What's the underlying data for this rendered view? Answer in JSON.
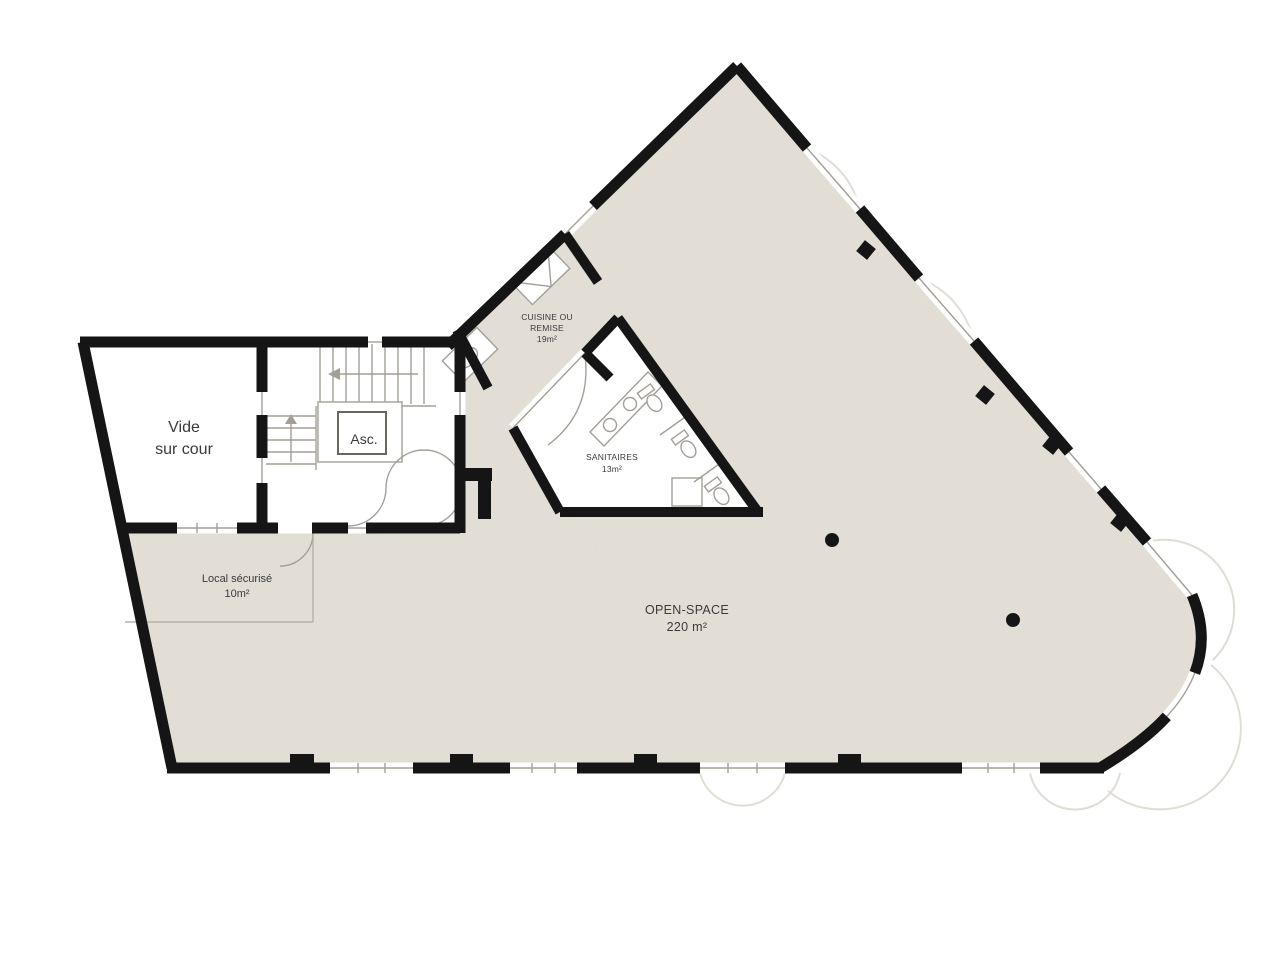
{
  "meta": {
    "type": "architectural-floor-plan",
    "language": "fr"
  },
  "colors": {
    "floor": "#e2ded6",
    "wall": "#151515",
    "thin_line": "#a39f97",
    "faint_line": "#e0ddd6",
    "room_white": "#ffffff",
    "text": "#3a3a3a"
  },
  "rooms": {
    "open_space": {
      "name": "OPEN-SPACE",
      "area": "220 m²"
    },
    "sanitaires": {
      "name": "SANITAIRES",
      "area": "13m²"
    },
    "cuisine": {
      "name_line1": "CUISINE OU",
      "name_line2": "REMISE",
      "area": "19m²"
    },
    "local_securise": {
      "name": "Local sécurisé",
      "area": "10m²"
    },
    "vide_sur_cour": {
      "name_line1": "Vide",
      "name_line2": "sur cour"
    },
    "elevator": {
      "name": "Asc."
    }
  }
}
